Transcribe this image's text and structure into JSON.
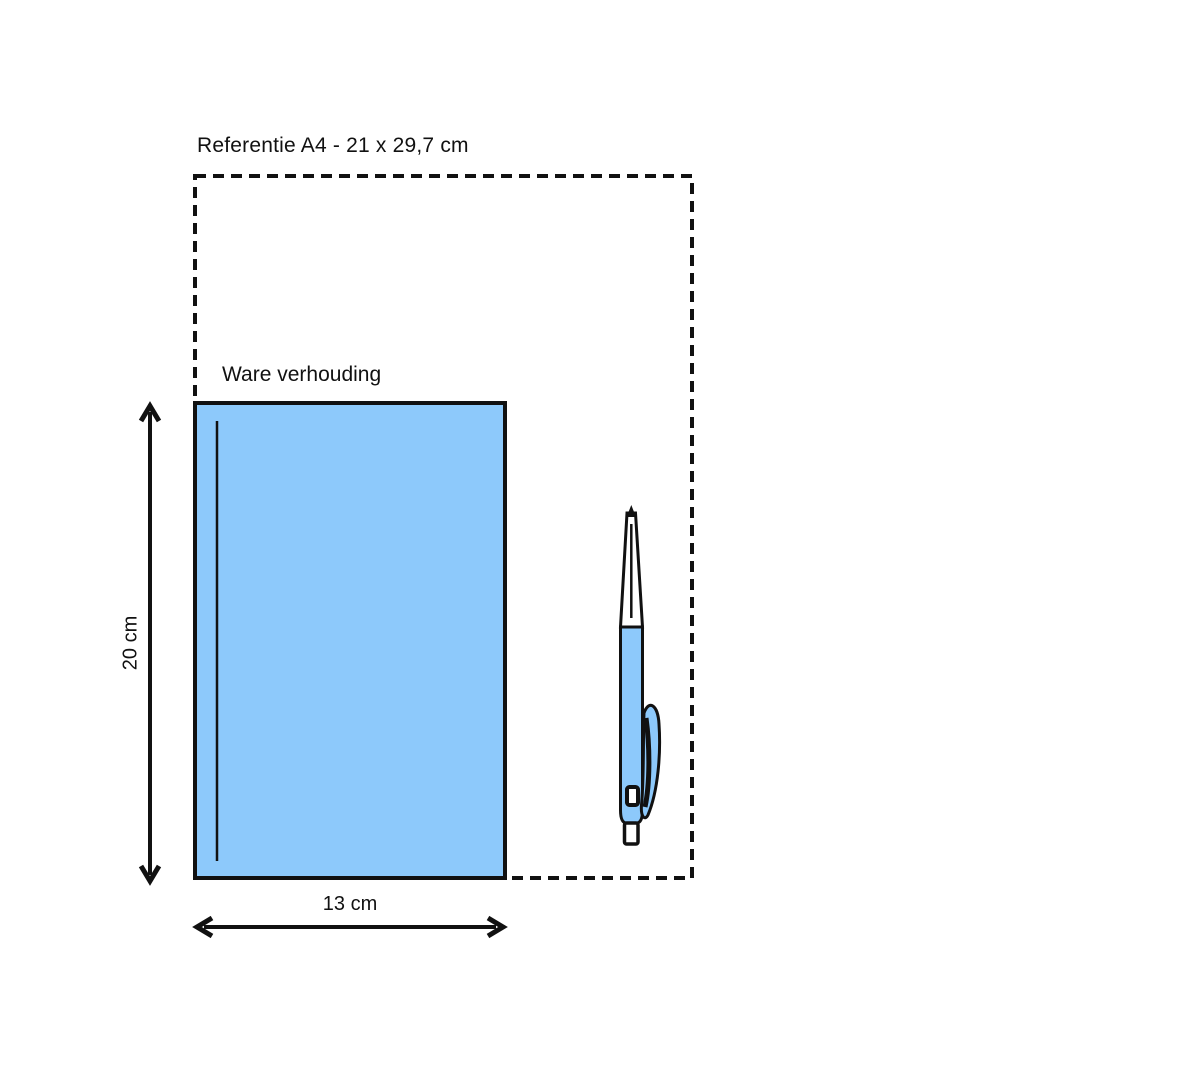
{
  "page": {
    "background_color": "#ffffff",
    "line_color": "#111111"
  },
  "diagram": {
    "title": "Referentie A4 - 21 x 29,7 cm",
    "book": {
      "label": "Ware verhouding",
      "fill_color": "#8DC9FB"
    },
    "dimensions": {
      "height_label": "20 cm",
      "width_label": "13 cm"
    },
    "pen": {
      "icon": "ballpoint-pen",
      "barrel_color": "#8DC9FB"
    }
  }
}
